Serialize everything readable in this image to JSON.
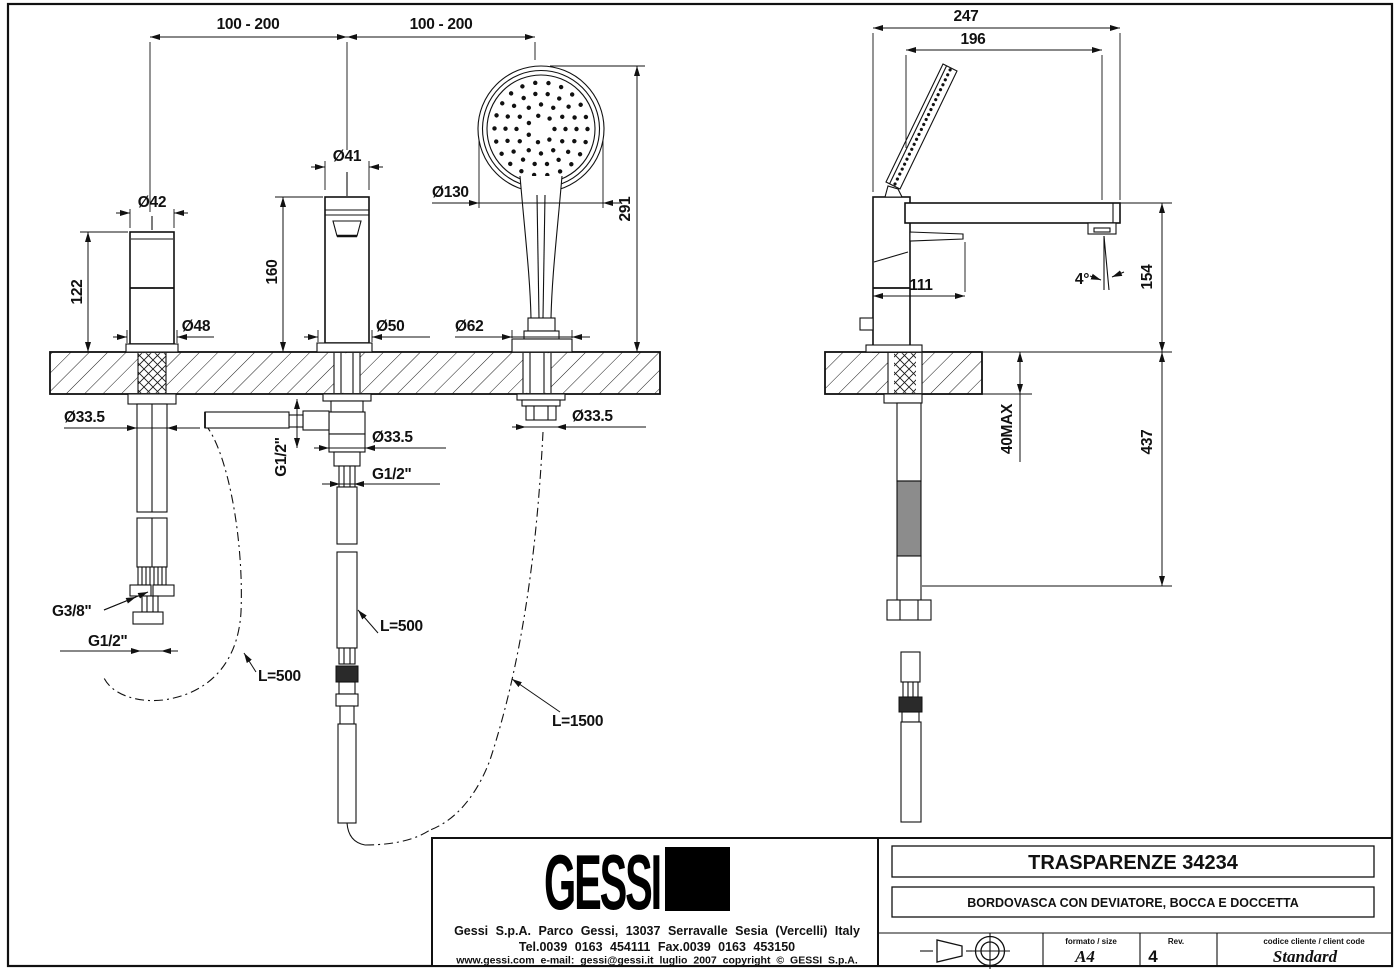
{
  "drawing": {
    "front_view": {
      "span_left": "100 - 200",
      "span_right": "100 - 200",
      "handle_dia_top": "Ø42",
      "handle_height": "122",
      "handle_dia_base": "Ø48",
      "handle_hole_dia": "Ø33.5",
      "spout_dia_top": "Ø41",
      "spout_height": "160",
      "spout_dia_base": "Ø50",
      "spout_hole_dia": "Ø33.5",
      "spout_thread_side": "G1/2\"",
      "spout_thread_bottom": "G1/2\"",
      "shower_dia_head": "Ø130",
      "shower_height": "291",
      "shower_dia_base": "Ø62",
      "shower_hole_dia": "Ø33.5",
      "supply_thread_g38": "G3/8\"",
      "supply_thread_g12": "G1/2\"",
      "hose_supply_length": "L=500",
      "hose_mid_length": "L=500",
      "hose_shower_length": "L=1500"
    },
    "side_view": {
      "depth_total": "247",
      "depth_head": "196",
      "reach": "111",
      "spout_angle": "4°",
      "height_above_deck": "154",
      "deck_thickness_max": "40MAX",
      "depth_below_deck": "437"
    }
  },
  "title_block": {
    "logo_text": "GESSI",
    "address": "Gessi S.p.A. Parco Gessi, 13037 Serravalle Sesia (Vercelli) Italy",
    "phone": "Tel.0039 0163 454111 Fax.0039 0163 453150",
    "web_line": "www.gessi.com e-mail: gessi@gessi.it luglio 2007 copyright © GESSI S.p.A.",
    "product_series": "TRASPARENZE 34234",
    "product_description": "BORDOVASCA CON DEVIATORE, BOCCA E DOCCETTA",
    "format_label": "formato / size",
    "format_value": "A4",
    "revision_label": "Rev.",
    "revision_value": "4",
    "client_code_label": "codice cliente / client code",
    "client_code_value": "Standard"
  }
}
